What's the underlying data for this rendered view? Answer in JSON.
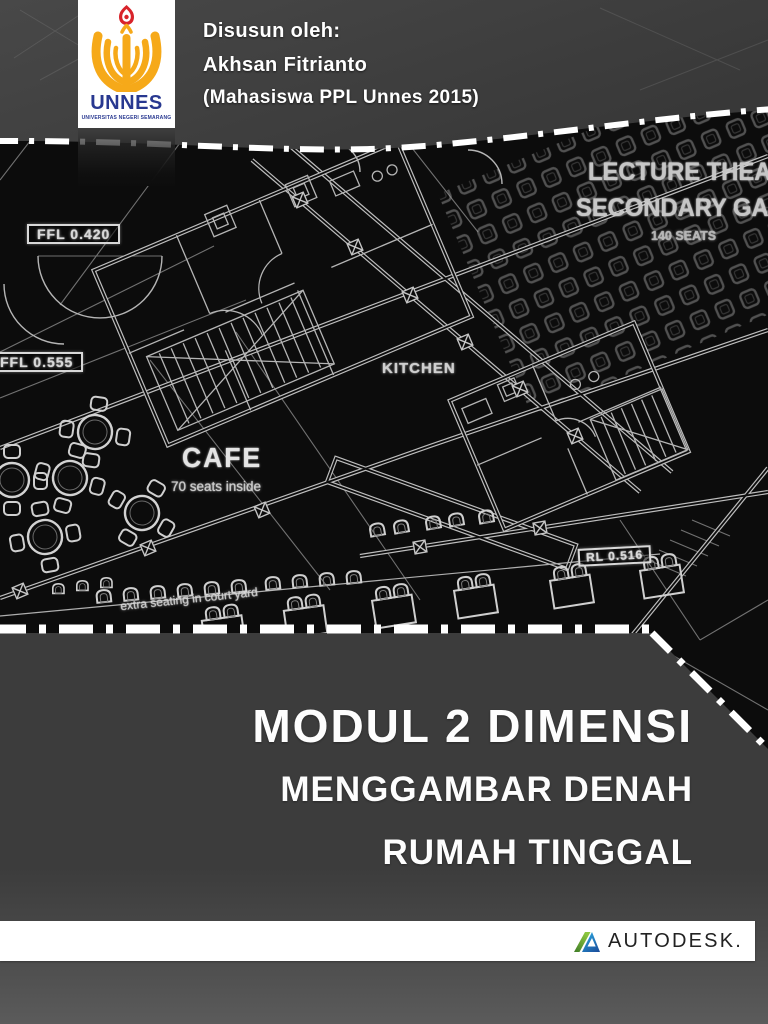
{
  "header": {
    "byline": "Disusun oleh:",
    "author": "Akhsan Fitrianto",
    "affiliation": "(Mahasiswa PPL Unnes 2015)"
  },
  "unnes_logo": {
    "name": "UNNES",
    "subtitle": "UNIVERSITAS NEGERI SEMARANG",
    "brand_blue": "#283890",
    "brand_gold": "#F6A919",
    "brand_red": "#D8232A"
  },
  "blueprint": {
    "labels": {
      "lecture_line1": "LECTURE THEATRE",
      "lecture_line2": "SECONDARY GALLERY",
      "lecture_capacity": "140 SEATS",
      "level_1": "FFL 0.420",
      "level_2": "FFL 0.555",
      "kitchen": "KITCHEN",
      "cafe": "CAFE",
      "cafe_capacity": "70 seats inside",
      "level_3": "RL 0.516",
      "courtyard": "extra seating in court yard"
    },
    "line_color": "#c9c9c9",
    "bg_color": "#0c0c0c"
  },
  "title_block": {
    "line1": "MODUL 2 DIMENSI",
    "line2": "MENGGAMBAR DENAH",
    "line3": "RUMAH TINGGAL"
  },
  "footer": {
    "wordmark": "AUTODESK.",
    "logo_green": "#7DB928",
    "logo_blue": "#1E62B0"
  }
}
